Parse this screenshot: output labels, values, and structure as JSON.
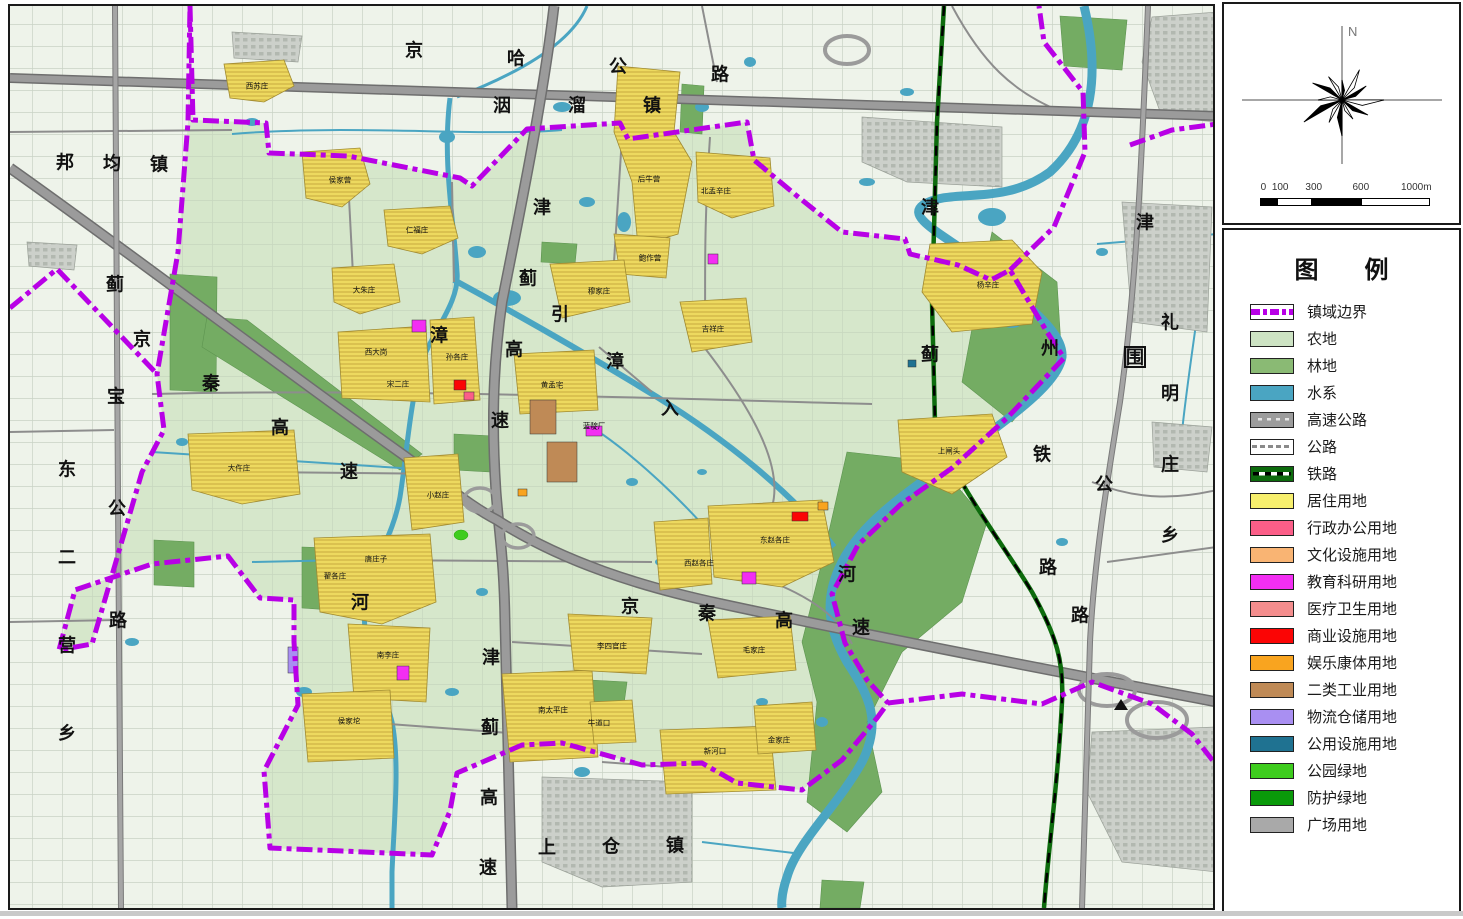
{
  "compass": {
    "north_label": "N",
    "scale_ticks": [
      "0",
      "100",
      "300",
      "600",
      "1000m"
    ]
  },
  "legend": {
    "title": "图例",
    "items": [
      {
        "label": "镇域边界",
        "type": "boundary",
        "color": "#b800e6"
      },
      {
        "label": "农地",
        "type": "fill",
        "color": "#cde3c3"
      },
      {
        "label": "林地",
        "type": "fill",
        "color": "#8aba74"
      },
      {
        "label": "水系",
        "type": "fill",
        "color": "#4aa5c2"
      },
      {
        "label": "高速公路",
        "type": "expressway",
        "color": "#9c9c9c"
      },
      {
        "label": "公路",
        "type": "road",
        "color": "#ffffff"
      },
      {
        "label": "铁路",
        "type": "railway",
        "color": "#0d6b0d"
      },
      {
        "label": "居住用地",
        "type": "fill",
        "color": "#f7ef6d"
      },
      {
        "label": "行政办公用地",
        "type": "fill",
        "color": "#fb5e88"
      },
      {
        "label": "文化设施用地",
        "type": "fill",
        "color": "#f9b473"
      },
      {
        "label": "教育科研用地",
        "type": "fill",
        "color": "#f32ef3"
      },
      {
        "label": "医疗卫生用地",
        "type": "fill",
        "color": "#f48d8d"
      },
      {
        "label": "商业设施用地",
        "type": "fill",
        "color": "#fb0505"
      },
      {
        "label": "娱乐康体用地",
        "type": "fill",
        "color": "#f9a41f"
      },
      {
        "label": "二类工业用地",
        "type": "fill",
        "color": "#bf8a56"
      },
      {
        "label": "物流仓储用地",
        "type": "fill",
        "color": "#a98ff2"
      },
      {
        "label": "公用设施用地",
        "type": "fill",
        "color": "#1f7291"
      },
      {
        "label": "公园绿地",
        "type": "fill",
        "color": "#3ecc1e"
      },
      {
        "label": "防护绿地",
        "type": "fill",
        "color": "#0a9a0a"
      },
      {
        "label": "广场用地",
        "type": "fill",
        "color": "#a9a9a9"
      }
    ]
  },
  "map": {
    "major_labels": [
      {
        "text": "京哈公路",
        "x": 412,
        "y": 48,
        "dx": 102,
        "dy": 8
      },
      {
        "text": "洇溜镇",
        "x": 500,
        "y": 103,
        "dx": 75,
        "dy": 0
      },
      {
        "text": "邦均镇",
        "x": 63,
        "y": 160,
        "dx": 47,
        "dy": 1
      },
      {
        "text": "东二营乡",
        "x": 65,
        "y": 467,
        "dx": 0,
        "dy": 88
      },
      {
        "text": "蓟宝公路",
        "x": 113,
        "y": 282,
        "dx": 1,
        "dy": 112
      },
      {
        "text": "京秦高速",
        "x": 140,
        "y": 337,
        "dx": 69,
        "dy": 44
      },
      {
        "text": "津蓟高速",
        "x": 540,
        "y": 205,
        "dx": -14,
        "dy": 71
      },
      {
        "text": "引漳入",
        "x": 558,
        "y": 312,
        "dx": 55,
        "dy": 47
      },
      {
        "text": "州",
        "x": 1048,
        "y": 346
      },
      {
        "text": "河",
        "x": 845,
        "y": 572
      },
      {
        "text": "漳",
        "x": 437,
        "y": 333
      },
      {
        "text": "河",
        "x": 358,
        "y": 600
      },
      {
        "text": "津",
        "x": 928,
        "y": 205
      },
      {
        "text": "蓟",
        "x": 928,
        "y": 352
      },
      {
        "text": "铁",
        "x": 1040,
        "y": 452
      },
      {
        "text": "路",
        "x": 1046,
        "y": 565
      },
      {
        "text": "津",
        "x": 1143,
        "y": 220
      },
      {
        "text": "围",
        "x": 1133,
        "y": 355,
        "boxed": true
      },
      {
        "text": "公",
        "x": 1102,
        "y": 482
      },
      {
        "text": "路",
        "x": 1078,
        "y": 613
      },
      {
        "text": "礼明庄乡",
        "x": 1168,
        "y": 320,
        "dx": 0,
        "dy": 71
      },
      {
        "text": "京秦高速",
        "x": 628,
        "y": 604,
        "dx": 77,
        "dy": 7
      },
      {
        "text": "津蓟高速",
        "x": 489,
        "y": 655,
        "dx": -1,
        "dy": 70
      },
      {
        "text": "上仓镇",
        "x": 545,
        "y": 845,
        "dx": 64,
        "dy": -1
      }
    ],
    "village_labels": [
      {
        "text": "西苏庄",
        "x": 255,
        "y": 84
      },
      {
        "text": "侯家营",
        "x": 338,
        "y": 178
      },
      {
        "text": "仁福庄",
        "x": 415,
        "y": 228
      },
      {
        "text": "大朱庄",
        "x": 362,
        "y": 288
      },
      {
        "text": "后牛营",
        "x": 647,
        "y": 177
      },
      {
        "text": "北孟辛庄",
        "x": 714,
        "y": 189
      },
      {
        "text": "鲍作营",
        "x": 648,
        "y": 256
      },
      {
        "text": "穆家庄",
        "x": 597,
        "y": 289
      },
      {
        "text": "吉祥庄",
        "x": 711,
        "y": 327
      },
      {
        "text": "杨辛庄",
        "x": 986,
        "y": 283
      },
      {
        "text": "孙各庄",
        "x": 455,
        "y": 355
      },
      {
        "text": "西大岗",
        "x": 374,
        "y": 350
      },
      {
        "text": "宋二庄",
        "x": 396,
        "y": 382
      },
      {
        "text": "黄孟宅",
        "x": 550,
        "y": 383
      },
      {
        "text": "蓝靛厂",
        "x": 592,
        "y": 424
      },
      {
        "text": "大仵庄",
        "x": 237,
        "y": 466
      },
      {
        "text": "小赵庄",
        "x": 436,
        "y": 493
      },
      {
        "text": "上闸头",
        "x": 947,
        "y": 449
      },
      {
        "text": "东赵各庄",
        "x": 773,
        "y": 538
      },
      {
        "text": "西赵各庄",
        "x": 697,
        "y": 561
      },
      {
        "text": "唐庄子",
        "x": 374,
        "y": 557
      },
      {
        "text": "翟各庄",
        "x": 333,
        "y": 574
      },
      {
        "text": "南李庄",
        "x": 386,
        "y": 653
      },
      {
        "text": "侯家坨",
        "x": 347,
        "y": 719
      },
      {
        "text": "李四官庄",
        "x": 610,
        "y": 644
      },
      {
        "text": "毛家庄",
        "x": 752,
        "y": 648
      },
      {
        "text": "南太平庄",
        "x": 551,
        "y": 708
      },
      {
        "text": "牛道口",
        "x": 597,
        "y": 721
      },
      {
        "text": "新河口",
        "x": 713,
        "y": 749
      },
      {
        "text": "金家庄",
        "x": 777,
        "y": 738
      }
    ]
  }
}
